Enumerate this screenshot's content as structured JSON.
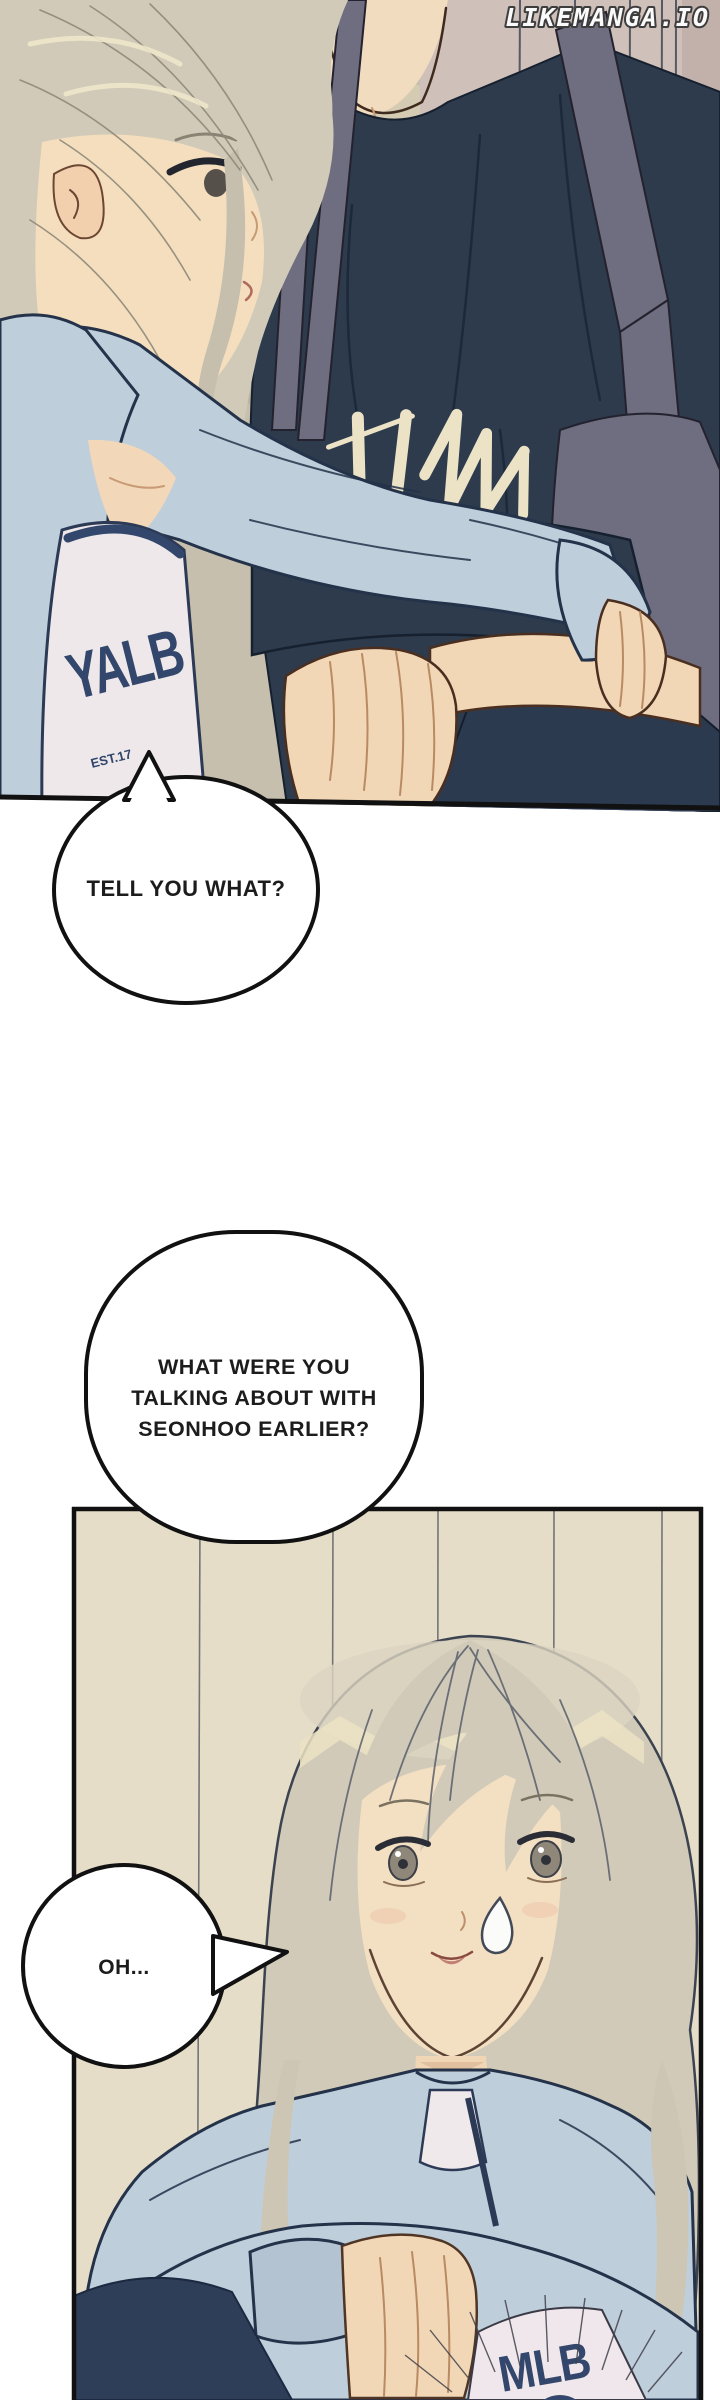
{
  "watermark": {
    "text": "LIKEMANGA.IO"
  },
  "speech_bubbles": {
    "bubble1": {
      "text": "TELL YOU WHAT?"
    },
    "bubble2": {
      "line1": "WHAT WERE YOU",
      "line2": "TALKING ABOUT WITH",
      "line3": "SEONHOO EARLIER?"
    },
    "bubble3": {
      "text": "OH..."
    }
  },
  "clothing_text": {
    "girl_tank_top_panel1": "YALB",
    "girl_tank_small_print": "EST.17",
    "girl_tank_bottom_panel2": "MLB"
  },
  "colors": {
    "page_bg": "#ffffff",
    "panel1_bg": "#c6bfad",
    "wood_top": "#cfc0b9",
    "wood_bottom": "#e5ddc8",
    "tee_navy": "#2d3b4d",
    "apron_gray": "#6e6e80",
    "cardigan_blue": "#bfcedb",
    "hair_blonde": "#d1cab8",
    "skin": "#f3dfc1",
    "logo_cream": "#ece2c6",
    "tank_text_navy": "#32476b",
    "outline_black": "#141414"
  }
}
